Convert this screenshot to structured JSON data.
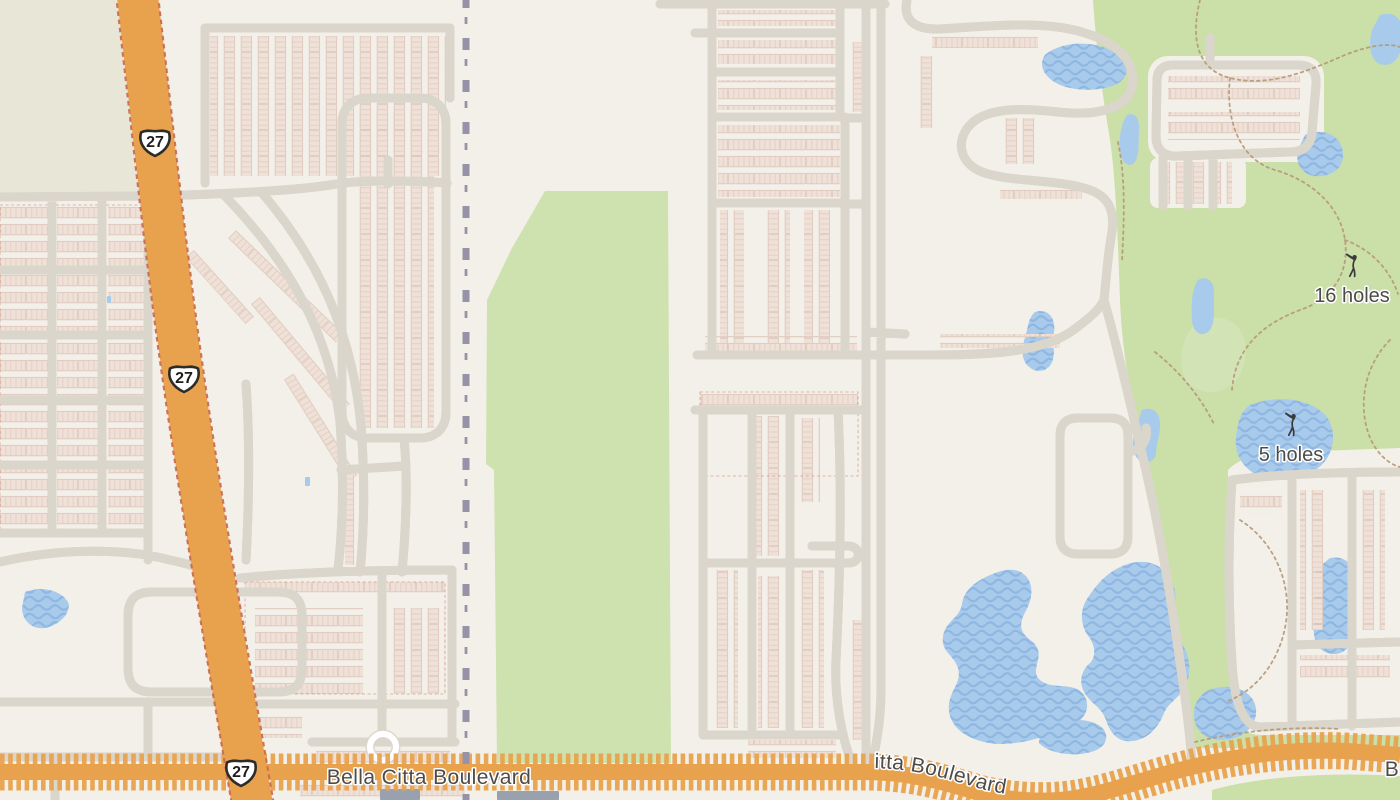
{
  "map": {
    "kind": "street-map",
    "labels": {
      "highway_shield": "27",
      "course_16": "16 holes",
      "course_5": "5 holes",
      "boulevard_name": "Bella Citta Boulevard",
      "boulevard_name_curved": "Bella Citta Boulevard",
      "boulevard_name_partial": "B"
    },
    "icons": [
      "golfer-icon",
      "us-highway-shield",
      "railway-line"
    ],
    "colors": {
      "background": "#F3F0E9",
      "olive_area": "#E8E6D7",
      "park_green": "#CBDFA9",
      "field_green": "#CEE2B0",
      "green_light": "#D9E8C1",
      "water": "#A8CAEB",
      "water_wave": "#90B7E1",
      "road": "#FFFFFF",
      "road_casing": "#DBD6CB",
      "highway": "#F8DF8F",
      "highway_casing": "#E8A24E",
      "highway_lane": "#EFC66F",
      "boulevard": "#FBE7A3",
      "trail_dash": "#C96B52",
      "cart_path": "#B59878",
      "railway": "#9693A9",
      "building": "#EFE1D8",
      "building_line": "#DFC9BD",
      "poi_building": "#9AA1AE",
      "label": "#4E4C48",
      "shield_border": "#2E2C29"
    }
  }
}
